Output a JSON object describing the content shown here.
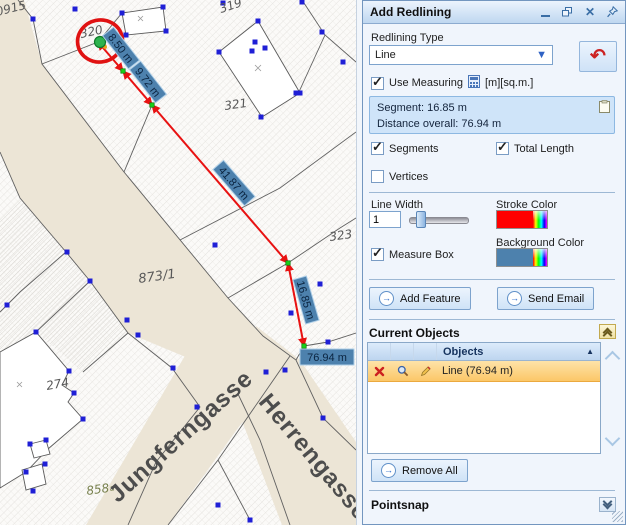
{
  "window": {
    "title": "Add Redlining"
  },
  "panel": {
    "redlining_type_label": "Redlining Type",
    "redlining_type_value": "Line",
    "use_measuring_label": "Use Measuring",
    "use_measuring_checked": true,
    "units_label": "[m][sq.m.]",
    "segment_info_line1": "Segment: 16.85 m",
    "segment_info_line2": "Distance overall: 76.94 m",
    "segments_label": "Segments",
    "segments_checked": true,
    "total_length_label": "Total Length",
    "total_length_checked": true,
    "vertices_label": "Vertices",
    "vertices_checked": false,
    "line_width_label": "Line Width",
    "line_width_value": "1",
    "stroke_color_label": "Stroke Color",
    "background_color_label": "Background Color",
    "measure_box_label": "Measure Box",
    "measure_box_checked": true,
    "add_feature_label": "Add Feature",
    "send_email_label": "Send Email",
    "current_objects_title": "Current Objects",
    "objects_column": "Objects",
    "object_row_label": "Line (76.94 m)",
    "remove_all_label": "Remove All",
    "pointsnap_title": "Pointsnap",
    "colors": {
      "stroke": "#ff0000",
      "background": "#4d81ad"
    }
  },
  "map": {
    "parcel_labels": {
      "p915": "0915",
      "p319": "319",
      "p320": "320",
      "p321": "321",
      "p323": "323",
      "p873": "873/1",
      "p274": "274",
      "p858": "858",
      "p858_suffix": "a"
    },
    "streets": {
      "jungferngasse": "Jungferngasse",
      "herrengasse": "Herrengasse"
    },
    "measure_labels": {
      "seg1": "8.50 m",
      "seg2": "9.72 m",
      "seg3": "41.87 m",
      "seg4": "16.85 m",
      "total": "76.94 m"
    },
    "colors": {
      "street": "#ece5d6",
      "measure_box": "#4d81ad",
      "redline": "#e81212",
      "snap_vertex": "#1f1fd6",
      "line_vertex": "#19cf19"
    }
  }
}
